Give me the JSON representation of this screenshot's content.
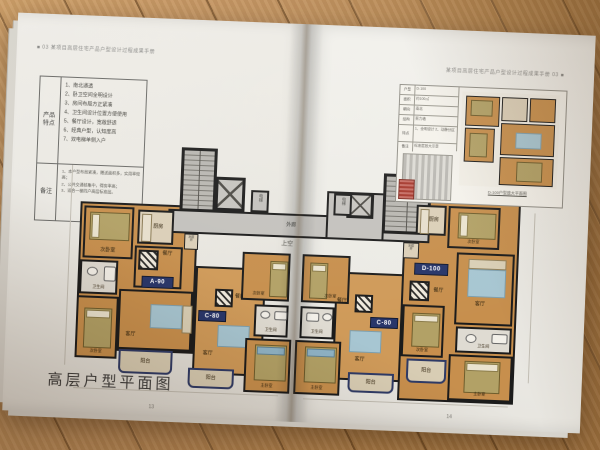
{
  "left": {
    "header": "■ 03  某项目高层住宅产品户型设计过程成果手册",
    "table": {
      "section1_label": "产品特点",
      "features": [
        "1、南北通透",
        "2、卧卫空间全明设计",
        "3、房间布局方正紧凑",
        "4、卫生间设计位置方便使用",
        "5、餐厅设计，宽敞舒适",
        "6、经典户型，认知度高",
        "7、双电梯单侧入户"
      ],
      "section2_label": "备注",
      "notes": [
        "1、本户型布局紧凑，赠送面积多，实用率较高；",
        "2、公共交通核集中，得房率高；",
        "3、适合一梯四户高层标准层。"
      ]
    },
    "title": "高层户型平面图",
    "page_number": "13"
  },
  "right": {
    "header": "某项目高层住宅产品户型设计过程成果手册  03 ■",
    "page_number": "14",
    "inset": {
      "rows": [
        {
          "label": "户型",
          "value": "D-100"
        },
        {
          "label": "面积",
          "value": "约100㎡"
        },
        {
          "label": "朝向",
          "value": "南北"
        },
        {
          "label": "结构",
          "value": "剪力墙"
        },
        {
          "label": "特点",
          "value": "1、全明设计 2、动静分区"
        },
        {
          "label": "备注",
          "value": "标准层放大示意"
        }
      ],
      "caption": "D-100户型放大平面图"
    }
  },
  "plan": {
    "badges": {
      "a90": "A-90",
      "c80": "C-80",
      "d100": "D-100"
    },
    "rooms": {
      "master": "主卧室",
      "bedroom2": "次卧室",
      "living": "客厅",
      "dining": "餐厅",
      "kitchen": "厨房",
      "bath": "卫生间",
      "balcony": "阳台",
      "corridor": "外廊",
      "void": "上空",
      "elevator": "电梯",
      "front_room": "前室",
      "shaft": "水暖井"
    }
  }
}
